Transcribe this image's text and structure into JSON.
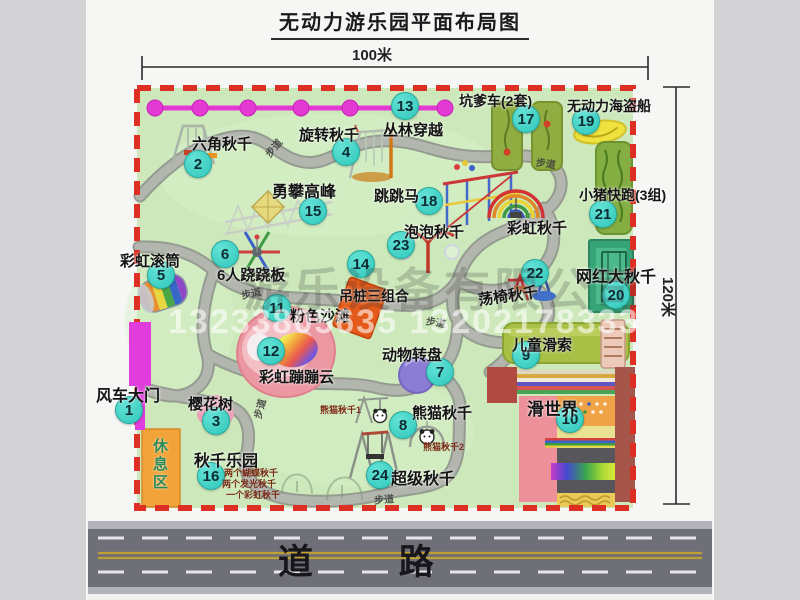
{
  "title": "无动力游乐园平面布局图",
  "dimensions": {
    "width": "100米",
    "height": "120米"
  },
  "road": {
    "label": "道 路"
  },
  "rest_area": {
    "label": "休息区"
  },
  "watermarks": {
    "phone": "13233805635 13202178333",
    "company": "游乐设备有限公司"
  },
  "colors": {
    "map_green": "#cde9bb",
    "border_red": "#dd2f23",
    "marker_teal": "#3fd6c9",
    "chain_magenta": "#e23ad2",
    "gate_magenta": "#e03ddc",
    "road_gray": "#6f6f77"
  },
  "map": {
    "items": [
      {
        "n": "1",
        "label": "风车大门",
        "lx": 96,
        "ly": 382,
        "cx": 129,
        "cy": 410,
        "fs": 16
      },
      {
        "n": "2",
        "label": "六角秋千",
        "lx": 192,
        "ly": 133,
        "cx": 198,
        "cy": 164,
        "fs": 15
      },
      {
        "n": "3",
        "label": "樱花树",
        "lx": 188,
        "ly": 393,
        "cx": 216,
        "cy": 421,
        "fs": 15
      },
      {
        "n": "4",
        "label": "旋转秋千",
        "lx": 299,
        "ly": 124,
        "cx": 346,
        "cy": 152,
        "fs": 15
      },
      {
        "n": "5",
        "label": "彩虹滚筒",
        "lx": 120,
        "ly": 250,
        "cx": 161,
        "cy": 275,
        "fs": 15
      },
      {
        "n": "6",
        "label": "6人跷跷板",
        "lx": 217,
        "ly": 264,
        "cx": 225,
        "cy": 254,
        "fs": 15
      },
      {
        "n": "7",
        "label": "动物转盘",
        "lx": 382,
        "ly": 344,
        "cx": 440,
        "cy": 372,
        "fs": 15
      },
      {
        "n": "8",
        "label": "熊猫秋千",
        "lx": 412,
        "ly": 402,
        "cx": 403,
        "cy": 425,
        "fs": 15
      },
      {
        "n": "9",
        "label": "儿童滑索",
        "lx": 512,
        "ly": 334,
        "cx": 526,
        "cy": 355,
        "fs": 15
      },
      {
        "n": "10",
        "label": "滑世界",
        "lx": 527,
        "ly": 395,
        "cx": 570,
        "cy": 419,
        "fs": 17
      },
      {
        "n": "11",
        "label": "粉色沙滩",
        "lx": 290,
        "ly": 305,
        "cx": 277,
        "cy": 308,
        "fs": 15
      },
      {
        "n": "12",
        "label": "彩虹蹦蹦云",
        "lx": 259,
        "ly": 366,
        "cx": 271,
        "cy": 351,
        "fs": 15
      },
      {
        "n": "13",
        "label": "丛林穿越",
        "lx": 383,
        "ly": 119,
        "cx": 405,
        "cy": 106,
        "fs": 15
      },
      {
        "n": "14",
        "label": "吊桩三组合",
        "lx": 339,
        "ly": 286,
        "cx": 361,
        "cy": 264,
        "fs": 14
      },
      {
        "n": "15",
        "label": "勇攀高峰",
        "lx": 272,
        "ly": 178,
        "cx": 313,
        "cy": 211,
        "fs": 16
      },
      {
        "n": "16",
        "label": "秋千乐园",
        "lx": 194,
        "ly": 447,
        "cx": 211,
        "cy": 476,
        "fs": 16
      },
      {
        "n": "17",
        "label": "坑爹车(2套)",
        "lx": 459,
        "ly": 91,
        "cx": 526,
        "cy": 119,
        "fs": 14
      },
      {
        "n": "18",
        "label": "跳跳马",
        "lx": 374,
        "ly": 185,
        "cx": 429,
        "cy": 201,
        "fs": 15
      },
      {
        "n": "19",
        "label": "无动力海盗船",
        "lx": 567,
        "ly": 96,
        "cx": 586,
        "cy": 121,
        "fs": 14
      },
      {
        "n": "20",
        "label": "网红大秋千",
        "lx": 576,
        "ly": 263,
        "cx": 616,
        "cy": 295,
        "fs": 16
      },
      {
        "n": "21",
        "label": "小猪快跑(3组)",
        "lx": 579,
        "ly": 185,
        "cx": 603,
        "cy": 214,
        "fs": 14
      },
      {
        "n": "22",
        "label": "荡椅秋千",
        "lx": 478,
        "ly": 285,
        "cx": 535,
        "cy": 273,
        "fs": 15,
        "rot": -8
      },
      {
        "n": "23",
        "label": "泡泡秋千",
        "lx": 404,
        "ly": 221,
        "cx": 401,
        "cy": 245,
        "fs": 15
      },
      {
        "n": "24",
        "label": "超级秋千",
        "lx": 391,
        "ly": 465,
        "cx": 380,
        "cy": 475,
        "fs": 16
      },
      {
        "n": null,
        "label": "彩虹秋千",
        "lx": 507,
        "ly": 217,
        "fs": 15
      }
    ],
    "sub_labels": [
      {
        "text": "熊猫秋千1",
        "x": 320,
        "y": 403
      },
      {
        "text": "熊猫秋千2",
        "x": 423,
        "y": 440
      },
      {
        "text": "两个蝴蝶秋千",
        "x": 224,
        "y": 466
      },
      {
        "text": "两个发光秋千",
        "x": 222,
        "y": 477
      },
      {
        "text": "一个彩虹秋千",
        "x": 226,
        "y": 488
      }
    ],
    "path_labels": [
      {
        "text": "步道",
        "x": 263,
        "y": 140,
        "rot": -50
      },
      {
        "text": "步道",
        "x": 536,
        "y": 155,
        "rot": 8
      },
      {
        "text": "步道",
        "x": 241,
        "y": 285,
        "rot": -12
      },
      {
        "text": "步道",
        "x": 426,
        "y": 314,
        "rot": 10
      },
      {
        "text": "步道",
        "x": 249,
        "y": 401,
        "rot": -75
      },
      {
        "text": "步道",
        "x": 374,
        "y": 491,
        "rot": -5
      }
    ]
  }
}
